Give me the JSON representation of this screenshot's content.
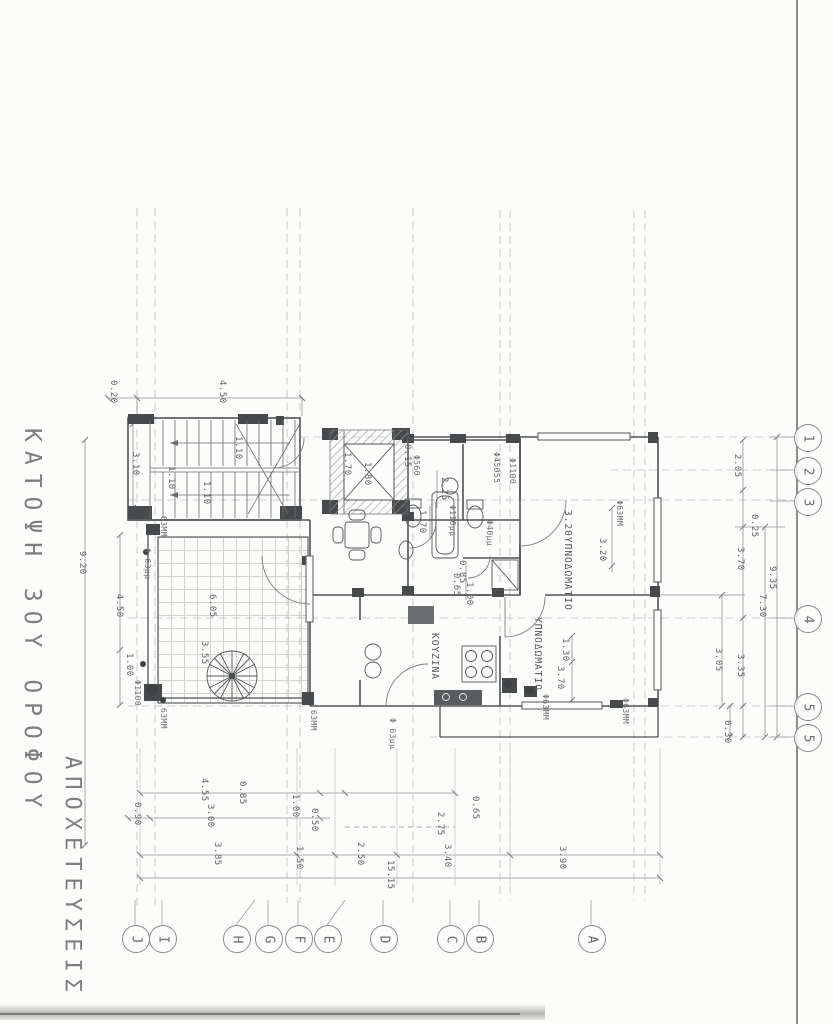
{
  "page": {
    "title_plan": "ΚΑΤΟΨΗ 3ΟΥ ΟΡΟΦΟΥ",
    "title_subject": "ΑΠΟΧΕΤΕΥΣΕΙΣ"
  },
  "colors": {
    "ink": "#55585a",
    "thin": "#8f9193",
    "construction": "#b7b9ba",
    "text": "#606366"
  },
  "grid_bubbles": {
    "bottom": [
      {
        "label": "J",
        "x": 135
      },
      {
        "label": "I",
        "x": 162
      },
      {
        "label": "H",
        "x": 236
      },
      {
        "label": "G",
        "x": 268
      },
      {
        "label": "F",
        "x": 298
      },
      {
        "label": "E",
        "x": 327
      },
      {
        "label": "D",
        "x": 383
      },
      {
        "label": "C",
        "x": 450
      },
      {
        "label": "B",
        "x": 479
      },
      {
        "label": "A",
        "x": 591
      }
    ],
    "right": [
      {
        "label": "1",
        "y": 437
      },
      {
        "label": "2",
        "y": 470
      },
      {
        "label": "3",
        "y": 501
      },
      {
        "label": "4",
        "y": 618
      },
      {
        "label": "5",
        "y": 706
      },
      {
        "label": "5",
        "y": 737
      }
    ]
  },
  "room_labels": [
    {
      "text": "ΚΟΥΖΙΝΑ",
      "x": 440,
      "y": 633
    },
    {
      "text": "ΥΠΝΟΔΩΜΑΤΙΟ",
      "x": 543,
      "y": 617
    },
    {
      "text": "3.20ΥΠΝΟΔΩΜΑΤΙΟ",
      "x": 573,
      "y": 510
    }
  ],
  "pipe_labels": [
    {
      "v": "Φ56Θ",
      "x": 421,
      "y": 455
    },
    {
      "v": "Φ45Θ55",
      "x": 501,
      "y": 452
    },
    {
      "v": "Φ110Θ",
      "x": 517,
      "y": 458
    },
    {
      "v": "Φ110μμ",
      "x": 457,
      "y": 505
    },
    {
      "v": "Φ40μμ",
      "x": 494,
      "y": 520
    },
    {
      "v": "Φ63ΜΜ",
      "x": 624,
      "y": 500
    },
    {
      "v": "63ΜΜ",
      "x": 168,
      "y": 516
    },
    {
      "v": "Φ 63μμ",
      "x": 152,
      "y": 548
    },
    {
      "v": "Φ110Θ",
      "x": 142,
      "y": 680
    },
    {
      "v": "63ΜΜ",
      "x": 168,
      "y": 708
    },
    {
      "v": "63ΜΜ",
      "x": 318,
      "y": 710
    },
    {
      "v": "Φ 63μμ",
      "x": 397,
      "y": 718
    },
    {
      "v": "Φ63ΜΜ",
      "x": 550,
      "y": 694
    },
    {
      "v": "Φ63ΜΜ",
      "x": 630,
      "y": 698
    }
  ],
  "dim_labels": [
    {
      "v": "0.20",
      "x": 118,
      "y": 380
    },
    {
      "v": "4.50",
      "x": 227,
      "y": 380
    },
    {
      "v": "3.10",
      "x": 140,
      "y": 452
    },
    {
      "v": "1.10",
      "x": 243,
      "y": 436
    },
    {
      "v": "1.10",
      "x": 176,
      "y": 466
    },
    {
      "v": "1.10",
      "x": 211,
      "y": 481
    },
    {
      "v": "0.15",
      "x": 412,
      "y": 444
    },
    {
      "v": "1.70",
      "x": 352,
      "y": 452
    },
    {
      "v": "1.80",
      "x": 372,
      "y": 462
    },
    {
      "v": "2.25",
      "x": 449,
      "y": 477
    },
    {
      "v": "1.70",
      "x": 427,
      "y": 510
    },
    {
      "v": "0.85",
      "x": 467,
      "y": 560
    },
    {
      "v": "0.65",
      "x": 461,
      "y": 573
    },
    {
      "v": "1.00",
      "x": 474,
      "y": 582
    },
    {
      "v": "9.20",
      "x": 87,
      "y": 551
    },
    {
      "v": "4.50",
      "x": 124,
      "y": 594
    },
    {
      "v": "1.00",
      "x": 134,
      "y": 653
    },
    {
      "v": "6.05",
      "x": 217,
      "y": 594
    },
    {
      "v": "3.55",
      "x": 209,
      "y": 641
    },
    {
      "v": "2.05",
      "x": 742,
      "y": 454
    },
    {
      "v": "0.25",
      "x": 759,
      "y": 514
    },
    {
      "v": "3.70",
      "x": 745,
      "y": 547
    },
    {
      "v": "9.35",
      "x": 777,
      "y": 566
    },
    {
      "v": "7.30",
      "x": 767,
      "y": 594
    },
    {
      "v": "3.20",
      "x": 607,
      "y": 538
    },
    {
      "v": "1.30",
      "x": 570,
      "y": 638
    },
    {
      "v": "3.70",
      "x": 565,
      "y": 666
    },
    {
      "v": "3.05",
      "x": 723,
      "y": 648
    },
    {
      "v": "3.35",
      "x": 745,
      "y": 654
    },
    {
      "v": "0.30",
      "x": 732,
      "y": 720
    },
    {
      "v": "0.90",
      "x": 142,
      "y": 802
    },
    {
      "v": "4.55",
      "x": 209,
      "y": 778
    },
    {
      "v": "3.00",
      "x": 215,
      "y": 804
    },
    {
      "v": "0.85",
      "x": 247,
      "y": 781
    },
    {
      "v": "1.00",
      "x": 300,
      "y": 794
    },
    {
      "v": "0.50",
      "x": 319,
      "y": 808
    },
    {
      "v": "3.85",
      "x": 222,
      "y": 842
    },
    {
      "v": "1.50",
      "x": 304,
      "y": 846
    },
    {
      "v": "2.50",
      "x": 365,
      "y": 842
    },
    {
      "v": "15.15",
      "x": 395,
      "y": 860
    },
    {
      "v": "0.65",
      "x": 480,
      "y": 796
    },
    {
      "v": "2.75",
      "x": 445,
      "y": 812
    },
    {
      "v": "3.40",
      "x": 452,
      "y": 844
    },
    {
      "v": "3.90",
      "x": 567,
      "y": 846
    }
  ]
}
